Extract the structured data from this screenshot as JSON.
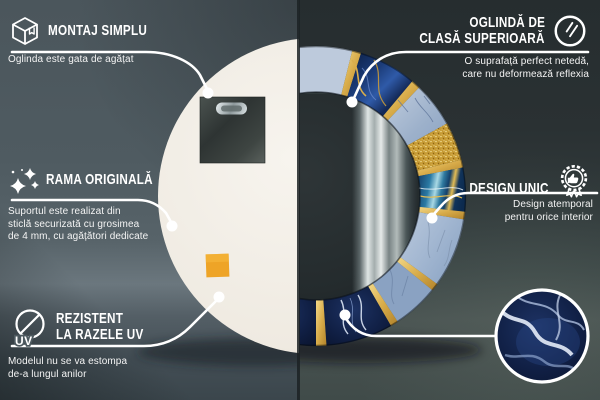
{
  "callouts": {
    "montaj": {
      "title": "MONTAJ SIMPLU",
      "desc": [
        "Oglinda este gata de agățat"
      ]
    },
    "oglinda": {
      "title_lines": [
        "OGLINDĂ DE",
        "CLASĂ SUPERIOARĂ"
      ],
      "desc": [
        "O suprafață perfect netedă,",
        "care nu deformează reflexia"
      ]
    },
    "rama": {
      "title": "RAMA ORIGINALĂ",
      "desc": [
        "Suportul este realizat din",
        "sticlă securizată cu grosimea",
        "de 4 mm, cu agățători dedicate"
      ]
    },
    "design": {
      "title": "DESIGN UNIC",
      "desc": [
        "Design atemporal",
        "pentru orice interior"
      ]
    },
    "uv": {
      "title_lines": [
        "REZISTENT",
        "LA RAZELE UV"
      ],
      "desc": [
        "Modelul nu se va estompa",
        "de-a lungul anilor"
      ],
      "icon_label": "UV"
    }
  },
  "colors": {
    "text": "#ffffff",
    "callout_line": "#ffffff",
    "gold": "#d8ac4a",
    "navy_marble": "#14284f",
    "light_marble": "#a9bcd6",
    "background_left": "#4d585c",
    "background_right": "#2c3334",
    "mirror_back": "#f1ede5",
    "sticker_orange": "#eea427"
  }
}
